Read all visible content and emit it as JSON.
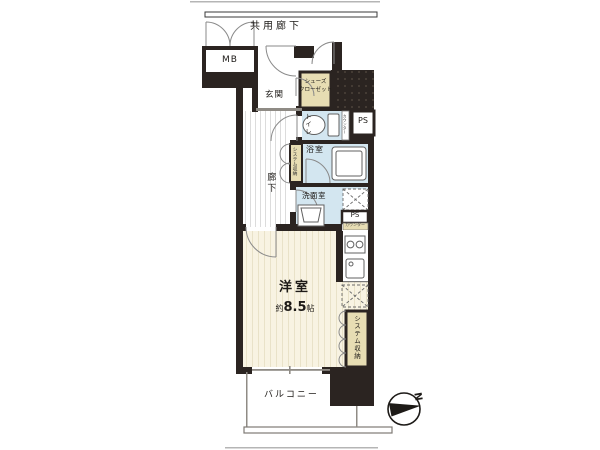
{
  "plan": {
    "type": "apartment-floor-plan",
    "corridor_label": "共用廊下",
    "rooms": {
      "mb": "MB",
      "entrance": "玄関",
      "shoe_closet": "シューズ\nクローゼット",
      "toilet": "トイレ",
      "toilet_counter": "カウンター",
      "ps_upper": "PS",
      "bathroom": "浴室",
      "hall_storage": "システム収納",
      "hallway": "廊下",
      "washroom": "洗面室",
      "ps_lower": "PS",
      "kitchen_counter": "カウンター",
      "main_room_name": "洋室",
      "main_room_area_prefix": "約",
      "main_room_area_value": "8.5",
      "main_room_area_unit": "帖",
      "room_storage": "システム収納",
      "balcony": "バルコニー"
    },
    "compass_label": "N",
    "colors": {
      "wall": "#2b2421",
      "water_room_floor": "#d3e6f0",
      "closet_fill": "#e7ddb3",
      "main_room_floor": "#f8f3e2"
    }
  }
}
